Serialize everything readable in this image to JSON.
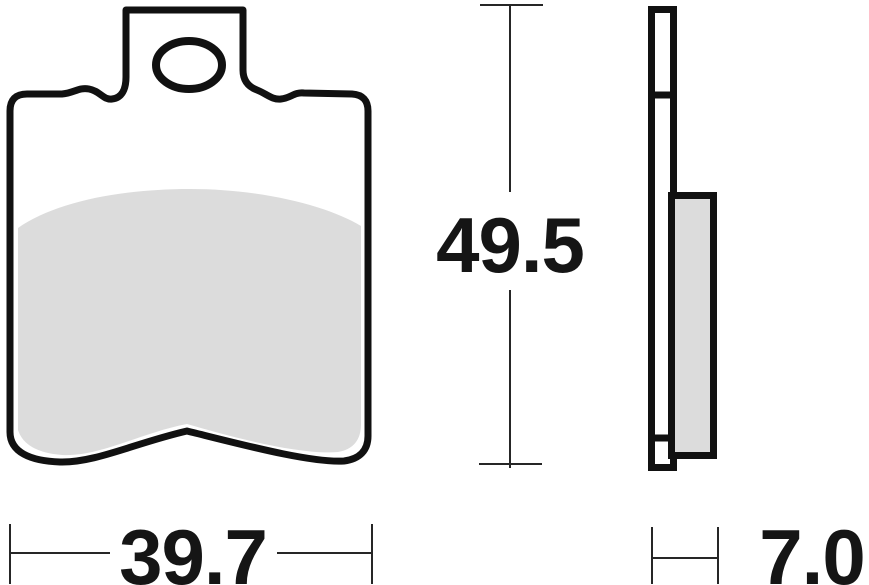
{
  "drawing": {
    "title": "brake-pad-technical-drawing",
    "views": {
      "front_view": "brake pad front profile with mounting tab and oval hole",
      "side_view": "brake pad side profile with backing plate and friction material"
    },
    "colors": {
      "line": "#111111",
      "pad_fill": "#dcdcdc",
      "background": "#ffffff",
      "dim_line": "#262626",
      "dim_text": "#151515"
    },
    "dimensions": {
      "height": {
        "value": "49.5",
        "orientation": "vertical"
      },
      "width": {
        "value": "39.7",
        "orientation": "horizontal"
      },
      "thickness": {
        "value": "7.0",
        "orientation": "horizontal"
      }
    }
  }
}
